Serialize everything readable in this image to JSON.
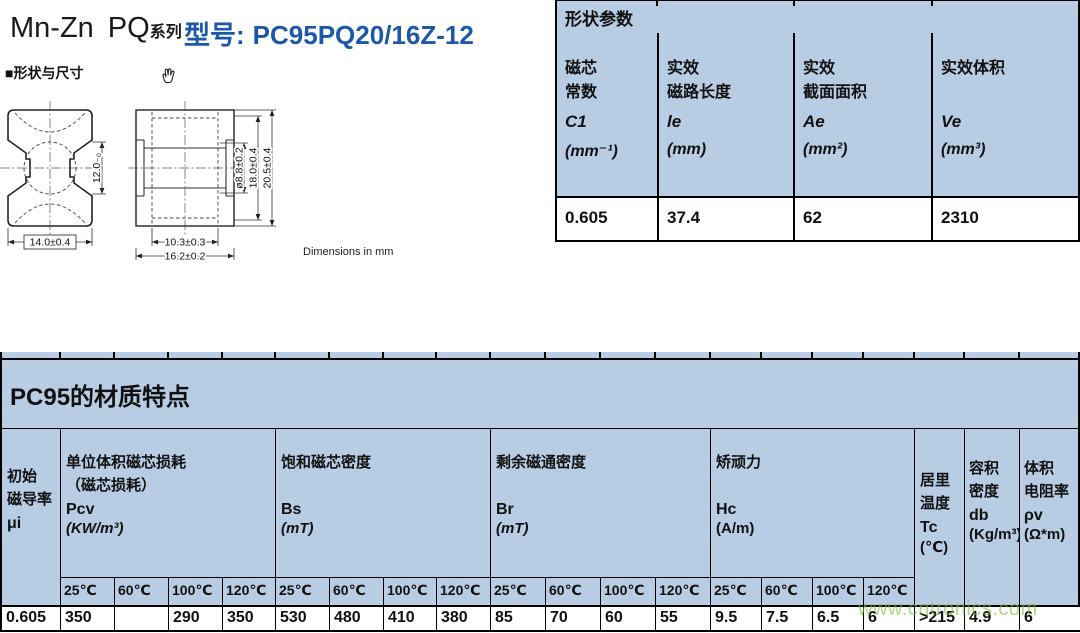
{
  "header": {
    "series_name": "Mn-Zn",
    "series_family": "PQ",
    "series_suffix": "系列",
    "model_label": "型号:",
    "model_number": "PC95PQ20/16Z-12"
  },
  "shape_section": {
    "bullet": "■",
    "title": "形状与尺寸",
    "note": "Dimensions in mm",
    "dims": {
      "front_width": "14.0±0.4",
      "front_mid_height": "12.0₋₀",
      "side_inner_width": "10.3±0.3",
      "side_outer_width": "16.2±0.2",
      "hole_diameter": "ø8.8±0.2",
      "inner_height": "18.0±0.4",
      "outer_height": "20.5±0.4"
    }
  },
  "shape_params": {
    "title": "形状参数",
    "columns": [
      {
        "line1": "磁芯",
        "line2": "常数",
        "symbol": "C1",
        "unit": "(mm⁻¹)",
        "value": "0.605"
      },
      {
        "line1": "实效",
        "line2": "磁路长度",
        "symbol": "le",
        "unit": "(mm)",
        "value": "37.4"
      },
      {
        "line1": "实效",
        "line2": "截面面积",
        "symbol": "Ae",
        "unit": "(mm²)",
        "value": "62"
      },
      {
        "line1": "实效体积",
        "line2": "",
        "symbol": "Ve",
        "unit": "(mm³)",
        "value": "2310"
      }
    ]
  },
  "material": {
    "title": "PC95的材质特点",
    "temps": [
      "25℃",
      "60℃",
      "100℃",
      "120℃"
    ],
    "mu": {
      "line1": "初始",
      "line2": "磁导率",
      "symbol": "μi",
      "value": "0.605"
    },
    "groups": [
      {
        "line1": "单位体积磁芯损耗",
        "line2": "（磁芯损耗）",
        "symbol": "Pcv",
        "unit": "(KW/m³)",
        "values": [
          "350",
          "",
          "290",
          "350"
        ]
      },
      {
        "line1": "饱和磁芯密度",
        "line2": "",
        "symbol": "Bs",
        "unit": "(mT)",
        "values": [
          "530",
          "480",
          "410",
          "380"
        ]
      },
      {
        "line1": "剩余磁通密度",
        "line2": "",
        "symbol": "Br",
        "unit": "(mT)",
        "values": [
          "85",
          "70",
          "60",
          "55"
        ]
      },
      {
        "line1": "矫顽力",
        "line2": "",
        "symbol": "Hc",
        "unit": "(A/m)",
        "values": [
          "9.5",
          "7.5",
          "6.5",
          "6"
        ]
      }
    ],
    "extras": [
      {
        "line1": "居里",
        "line2": "温度",
        "symbol": "Tc",
        "unit": "(℃)",
        "value": ">215"
      },
      {
        "line1": "容积",
        "line2": "密度",
        "symbol": "db",
        "unit": "(Kg/m³)*10³",
        "value": "4.9"
      },
      {
        "line1": "体积",
        "line2": "电阻率",
        "symbol": "ρv",
        "unit": "(Ω*m)",
        "value": "6"
      }
    ]
  },
  "watermark": "www.cntronics.com",
  "colors": {
    "accent_blue": "#1d57a8",
    "table_header_bg": "#b8cce4",
    "watermark_green": "#7dbe3c"
  }
}
